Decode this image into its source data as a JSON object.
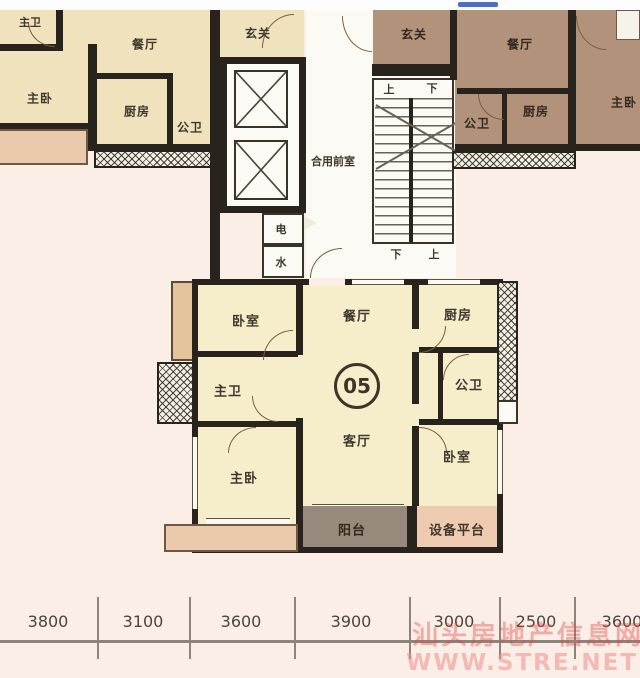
{
  "top_bar": {
    "color": "#4a70c4"
  },
  "left_unit": {
    "master_bath": "主卫",
    "dining": "餐厅",
    "master_bed": "主卧",
    "kitchen": "厨房",
    "bath": "公卫",
    "entry": "玄关"
  },
  "core": {
    "lobby": "合用前室",
    "electricity": "电",
    "water": "水",
    "stair_top_left": "上",
    "stair_top_right": "下",
    "stair_bottom_left": "下",
    "stair_bottom_right": "上"
  },
  "right_unit": {
    "entry": "玄关",
    "dining": "餐厅",
    "bath": "公卫",
    "kitchen": "厨房",
    "master_bed": "主卧"
  },
  "unit05": {
    "number": "05",
    "bedroom_top": "卧室",
    "dining": "餐厅",
    "kitchen": "厨房",
    "master_bath": "主卫",
    "bath": "公卫",
    "living": "客厅",
    "master_bed": "主卧",
    "bedroom_right": "卧室",
    "balcony": "阳台",
    "equipment_platform": "设备平台"
  },
  "dimensions": {
    "values": [
      "3800",
      "3100",
      "3600",
      "3900",
      "3000",
      "2500",
      "3600"
    ]
  },
  "watermark": {
    "line1": "汕头房地产信息网",
    "line2": "WWW.STRE.NET"
  },
  "colors": {
    "left_unit_fill": "#f0e2bd",
    "right_unit_fill": "#b2927a",
    "unit05_fill": "#f6eeca",
    "balcony_fill": "#97897b",
    "equipment_fill": "#eecab1",
    "wall": "#28231d",
    "watermark": "#e06a6a",
    "top_bar": "#4a70c4"
  }
}
